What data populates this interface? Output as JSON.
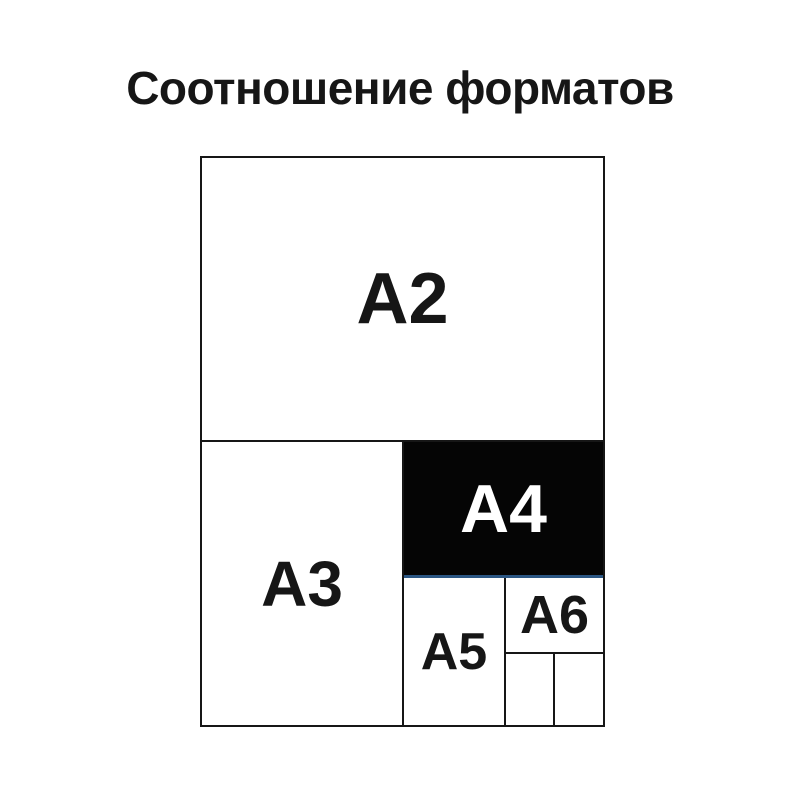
{
  "title": "Соотношение форматов",
  "colors": {
    "background": "#ffffff",
    "border": "#161616",
    "text": "#161616",
    "highlight_fill": "#050505",
    "highlight_text": "#ffffff",
    "accent_underline": "#2b5683"
  },
  "diagram": {
    "description": "nested-paper-format-size-comparison",
    "highlighted_format": "A4",
    "formats": [
      {
        "label": "A2",
        "highlighted": false
      },
      {
        "label": "A3",
        "highlighted": false
      },
      {
        "label": "A4",
        "highlighted": true
      },
      {
        "label": "A5",
        "highlighted": false
      },
      {
        "label": "A6",
        "highlighted": false
      },
      {
        "label": "",
        "highlighted": false
      },
      {
        "label": "",
        "highlighted": false
      }
    ]
  }
}
